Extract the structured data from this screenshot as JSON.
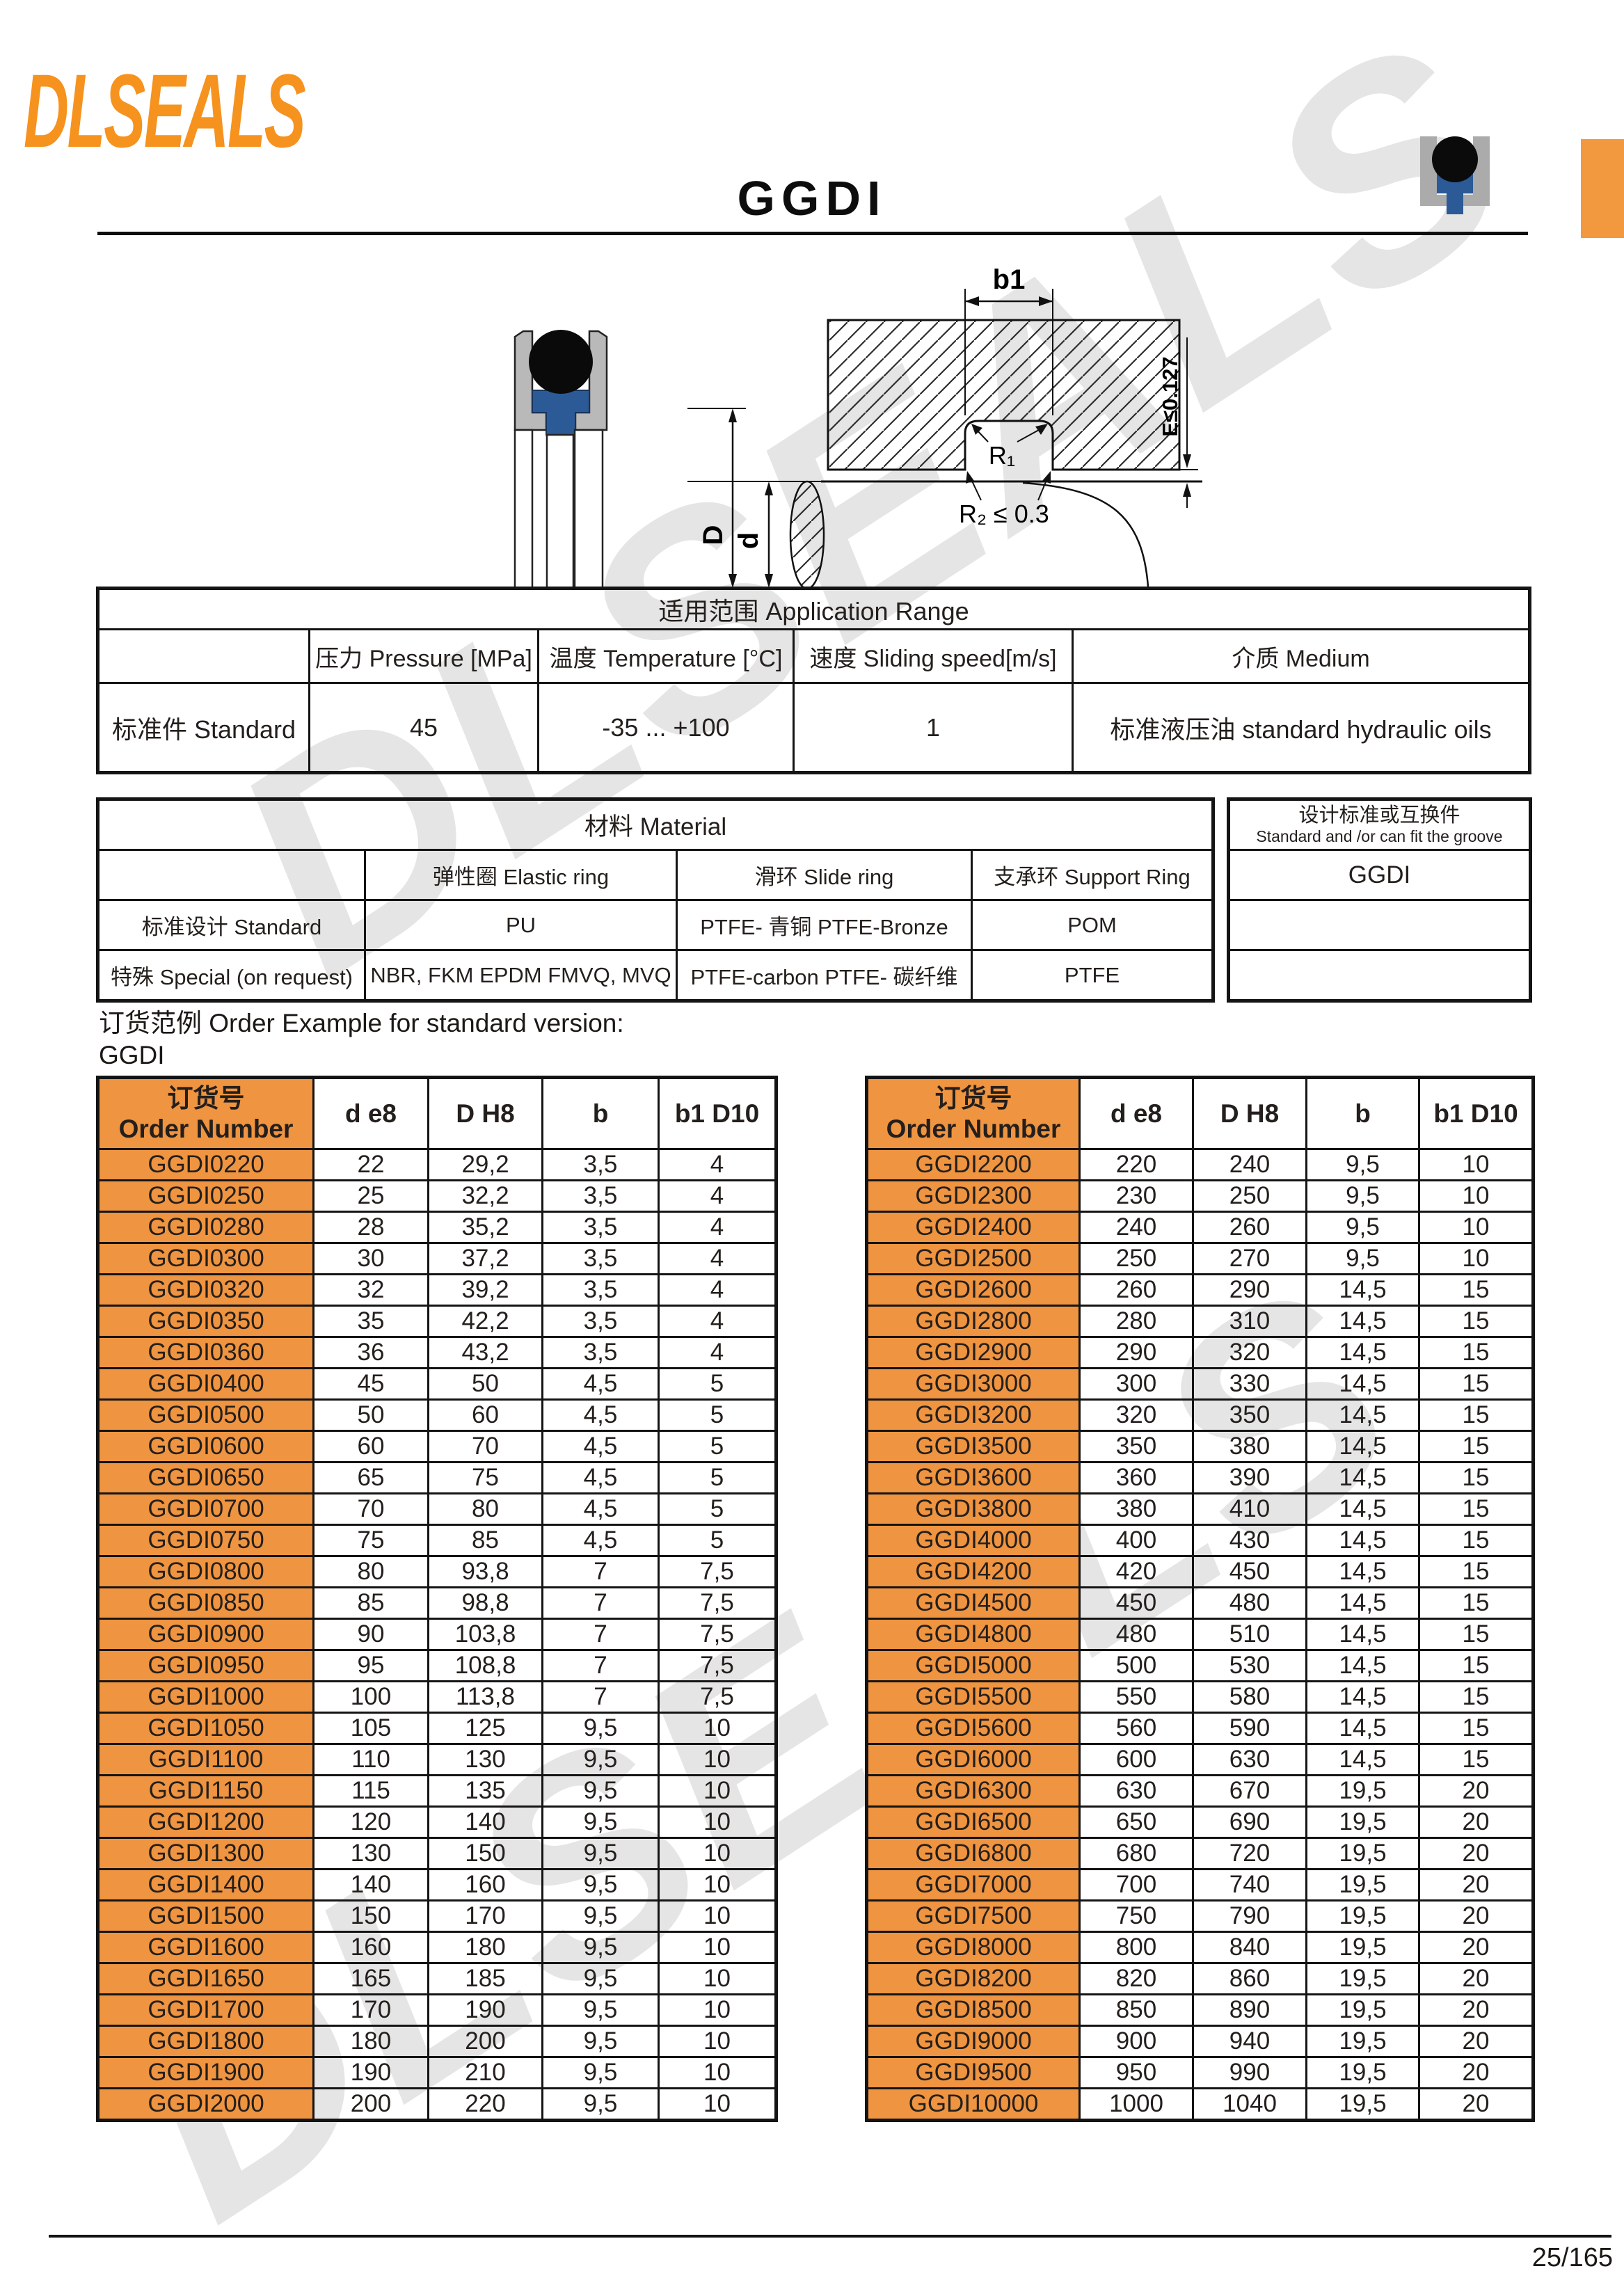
{
  "brand": {
    "logo_text": "DLSEALS"
  },
  "header": {
    "title": "GGDI"
  },
  "watermark": {
    "text": "DLSEALS"
  },
  "colors": {
    "accent_orange": "#EF9440",
    "logo_orange": "#F6921E",
    "tab_orange": "#F2993F",
    "seal_blue": "#2B5A96",
    "housing_gray": "#B9B9B9"
  },
  "application_range": {
    "title": "适用范围 Application Range",
    "col_pressure": "压力 Pressure [MPa]",
    "col_temperature": "温度 Temperature [°C]",
    "col_speed": "速度 Sliding speed[m/s]",
    "col_medium": "介质 Medium",
    "row_label": "标准件 Standard",
    "pressure": "45",
    "temperature": "-35 ... +100",
    "speed": "1",
    "medium": "标准液压油 standard hydraulic oils"
  },
  "material": {
    "title": "材料 Material",
    "col_elastic": "弹性圈 Elastic ring",
    "col_slide": "滑环 Slide ring",
    "col_support": "支承环 Support Ring",
    "row1_label": "标准设计 Standard",
    "row1_elastic": "PU",
    "row1_slide": "PTFE- 青铜 PTFE-Bronze",
    "row1_support": "POM",
    "row2_label": "特殊 Special (on request)",
    "row2_elastic": "NBR, FKM EPDM FMVQ, MVQ",
    "row2_slide": "PTFE-carbon PTFE- 碳纤维",
    "row2_support": "PTFE"
  },
  "groove_standard": {
    "title_cn": "设计标准或互换件",
    "title_en": "Standard and /or can fit the groove",
    "value": "GGDI"
  },
  "order_example": {
    "line1": "订货范例 Order Example for standard version:",
    "line2": "GGDI"
  },
  "size_table": {
    "col_order_cn": "订货号",
    "col_order_en": "Order Number",
    "col_d": "d e8",
    "col_D": "D H8",
    "col_b": "b",
    "col_b1": "b1 D10",
    "left_rows": [
      [
        "GGDI0220",
        "22",
        "29,2",
        "3,5",
        "4"
      ],
      [
        "GGDI0250",
        "25",
        "32,2",
        "3,5",
        "4"
      ],
      [
        "GGDI0280",
        "28",
        "35,2",
        "3,5",
        "4"
      ],
      [
        "GGDI0300",
        "30",
        "37,2",
        "3,5",
        "4"
      ],
      [
        "GGDI0320",
        "32",
        "39,2",
        "3,5",
        "4"
      ],
      [
        "GGDI0350",
        "35",
        "42,2",
        "3,5",
        "4"
      ],
      [
        "GGDI0360",
        "36",
        "43,2",
        "3,5",
        "4"
      ],
      [
        "GGDI0400",
        "45",
        "50",
        "4,5",
        "5"
      ],
      [
        "GGDI0500",
        "50",
        "60",
        "4,5",
        "5"
      ],
      [
        "GGDI0600",
        "60",
        "70",
        "4,5",
        "5"
      ],
      [
        "GGDI0650",
        "65",
        "75",
        "4,5",
        "5"
      ],
      [
        "GGDI0700",
        "70",
        "80",
        "4,5",
        "5"
      ],
      [
        "GGDI0750",
        "75",
        "85",
        "4,5",
        "5"
      ],
      [
        "GGDI0800",
        "80",
        "93,8",
        "7",
        "7,5"
      ],
      [
        "GGDI0850",
        "85",
        "98,8",
        "7",
        "7,5"
      ],
      [
        "GGDI0900",
        "90",
        "103,8",
        "7",
        "7,5"
      ],
      [
        "GGDI0950",
        "95",
        "108,8",
        "7",
        "7,5"
      ],
      [
        "GGDI1000",
        "100",
        "113,8",
        "7",
        "7,5"
      ],
      [
        "GGDI1050",
        "105",
        "125",
        "9,5",
        "10"
      ],
      [
        "GGDI1100",
        "110",
        "130",
        "9,5",
        "10"
      ],
      [
        "GGDI1150",
        "115",
        "135",
        "9,5",
        "10"
      ],
      [
        "GGDI1200",
        "120",
        "140",
        "9,5",
        "10"
      ],
      [
        "GGDI1300",
        "130",
        "150",
        "9,5",
        "10"
      ],
      [
        "GGDI1400",
        "140",
        "160",
        "9,5",
        "10"
      ],
      [
        "GGDI1500",
        "150",
        "170",
        "9,5",
        "10"
      ],
      [
        "GGDI1600",
        "160",
        "180",
        "9,5",
        "10"
      ],
      [
        "GGDI1650",
        "165",
        "185",
        "9,5",
        "10"
      ],
      [
        "GGDI1700",
        "170",
        "190",
        "9,5",
        "10"
      ],
      [
        "GGDI1800",
        "180",
        "200",
        "9,5",
        "10"
      ],
      [
        "GGDI1900",
        "190",
        "210",
        "9,5",
        "10"
      ],
      [
        "GGDI2000",
        "200",
        "220",
        "9,5",
        "10"
      ]
    ],
    "right_rows": [
      [
        "GGDI2200",
        "220",
        "240",
        "9,5",
        "10"
      ],
      [
        "GGDI2300",
        "230",
        "250",
        "9,5",
        "10"
      ],
      [
        "GGDI2400",
        "240",
        "260",
        "9,5",
        "10"
      ],
      [
        "GGDI2500",
        "250",
        "270",
        "9,5",
        "10"
      ],
      [
        "GGDI2600",
        "260",
        "290",
        "14,5",
        "15"
      ],
      [
        "GGDI2800",
        "280",
        "310",
        "14,5",
        "15"
      ],
      [
        "GGDI2900",
        "290",
        "320",
        "14,5",
        "15"
      ],
      [
        "GGDI3000",
        "300",
        "330",
        "14,5",
        "15"
      ],
      [
        "GGDI3200",
        "320",
        "350",
        "14,5",
        "15"
      ],
      [
        "GGDI3500",
        "350",
        "380",
        "14,5",
        "15"
      ],
      [
        "GGDI3600",
        "360",
        "390",
        "14,5",
        "15"
      ],
      [
        "GGDI3800",
        "380",
        "410",
        "14,5",
        "15"
      ],
      [
        "GGDI4000",
        "400",
        "430",
        "14,5",
        "15"
      ],
      [
        "GGDI4200",
        "420",
        "450",
        "14,5",
        "15"
      ],
      [
        "GGDI4500",
        "450",
        "480",
        "14,5",
        "15"
      ],
      [
        "GGDI4800",
        "480",
        "510",
        "14,5",
        "15"
      ],
      [
        "GGDI5000",
        "500",
        "530",
        "14,5",
        "15"
      ],
      [
        "GGDI5500",
        "550",
        "580",
        "14,5",
        "15"
      ],
      [
        "GGDI5600",
        "560",
        "590",
        "14,5",
        "15"
      ],
      [
        "GGDI6000",
        "600",
        "630",
        "14,5",
        "15"
      ],
      [
        "GGDI6300",
        "630",
        "670",
        "19,5",
        "20"
      ],
      [
        "GGDI6500",
        "650",
        "690",
        "19,5",
        "20"
      ],
      [
        "GGDI6800",
        "680",
        "720",
        "19,5",
        "20"
      ],
      [
        "GGDI7000",
        "700",
        "740",
        "19,5",
        "20"
      ],
      [
        "GGDI7500",
        "750",
        "790",
        "19,5",
        "20"
      ],
      [
        "GGDI8000",
        "800",
        "840",
        "19,5",
        "20"
      ],
      [
        "GGDI8200",
        "820",
        "860",
        "19,5",
        "20"
      ],
      [
        "GGDI8500",
        "850",
        "890",
        "19,5",
        "20"
      ],
      [
        "GGDI9000",
        "900",
        "940",
        "19,5",
        "20"
      ],
      [
        "GGDI9500",
        "950",
        "990",
        "19,5",
        "20"
      ],
      [
        "GGDI10000",
        "1000",
        "1040",
        "19,5",
        "20"
      ]
    ]
  },
  "diagram": {
    "label_b1": "b1",
    "label_r1": "R₁",
    "label_r2": "R₂ ≤ 0.3",
    "label_e": "E≤0.127",
    "label_D": "D",
    "label_d": "d"
  },
  "footer": {
    "page_number": "25/165"
  }
}
